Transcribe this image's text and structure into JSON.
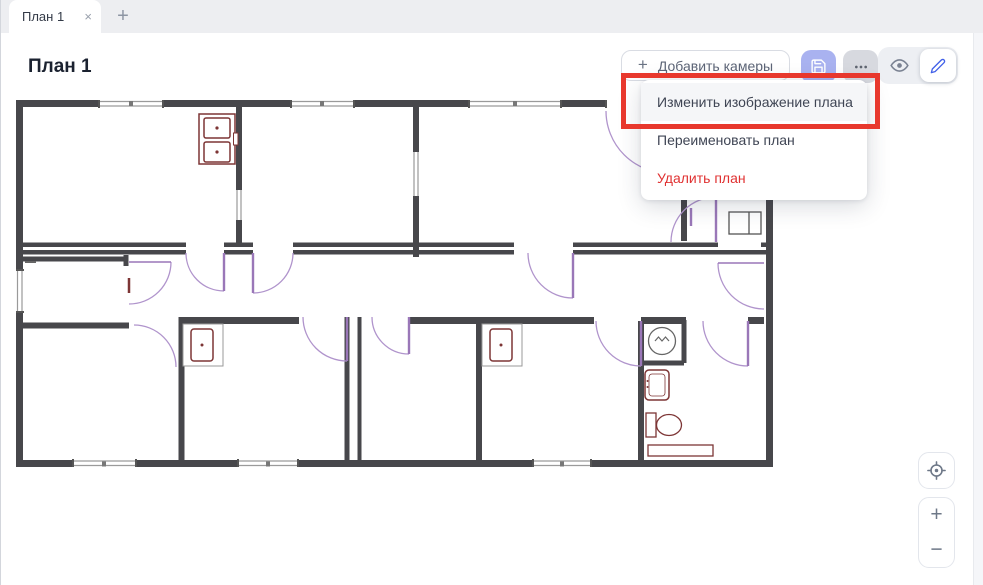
{
  "tab_bar": {
    "tabs": [
      {
        "label": "План 1",
        "close_icon": "×",
        "active": true
      }
    ],
    "new_tab_icon": "+"
  },
  "header": {
    "title": "План 1"
  },
  "toolbar": {
    "add_cameras_button": {
      "icon": "+",
      "label": "Добавить камеры"
    },
    "save_button": {
      "icon_name": "floppy-icon",
      "bg_color": "#a9b2f0"
    },
    "more_button": {
      "icon_name": "ellipsis-icon"
    },
    "mode_toggle": {
      "view_icon_name": "eye-icon",
      "edit_icon_name": "pencil-icon",
      "active_mode": "edit",
      "edit_accent": "#4160e8"
    }
  },
  "context_menu": {
    "items": [
      {
        "label": "Изменить изображение плана",
        "style": "default",
        "highlighted": true
      },
      {
        "label": "Переименовать план",
        "style": "default",
        "highlighted": false
      },
      {
        "label": "Удалить план",
        "style": "danger",
        "highlighted": false
      }
    ],
    "danger_color": "#e03131"
  },
  "annotation": {
    "shape": "rectangle",
    "color": "#e8382d",
    "highlights": "Изменить изображение плана"
  },
  "canvas": {
    "content": "floor-plan-drawing",
    "wall_color": "#47474b",
    "door_color": "#b094cc",
    "fixture_color": "#7d3535"
  },
  "map_controls": {
    "locate_icon_name": "crosshair-icon",
    "zoom_in_label": "+",
    "zoom_out_label": "−"
  }
}
